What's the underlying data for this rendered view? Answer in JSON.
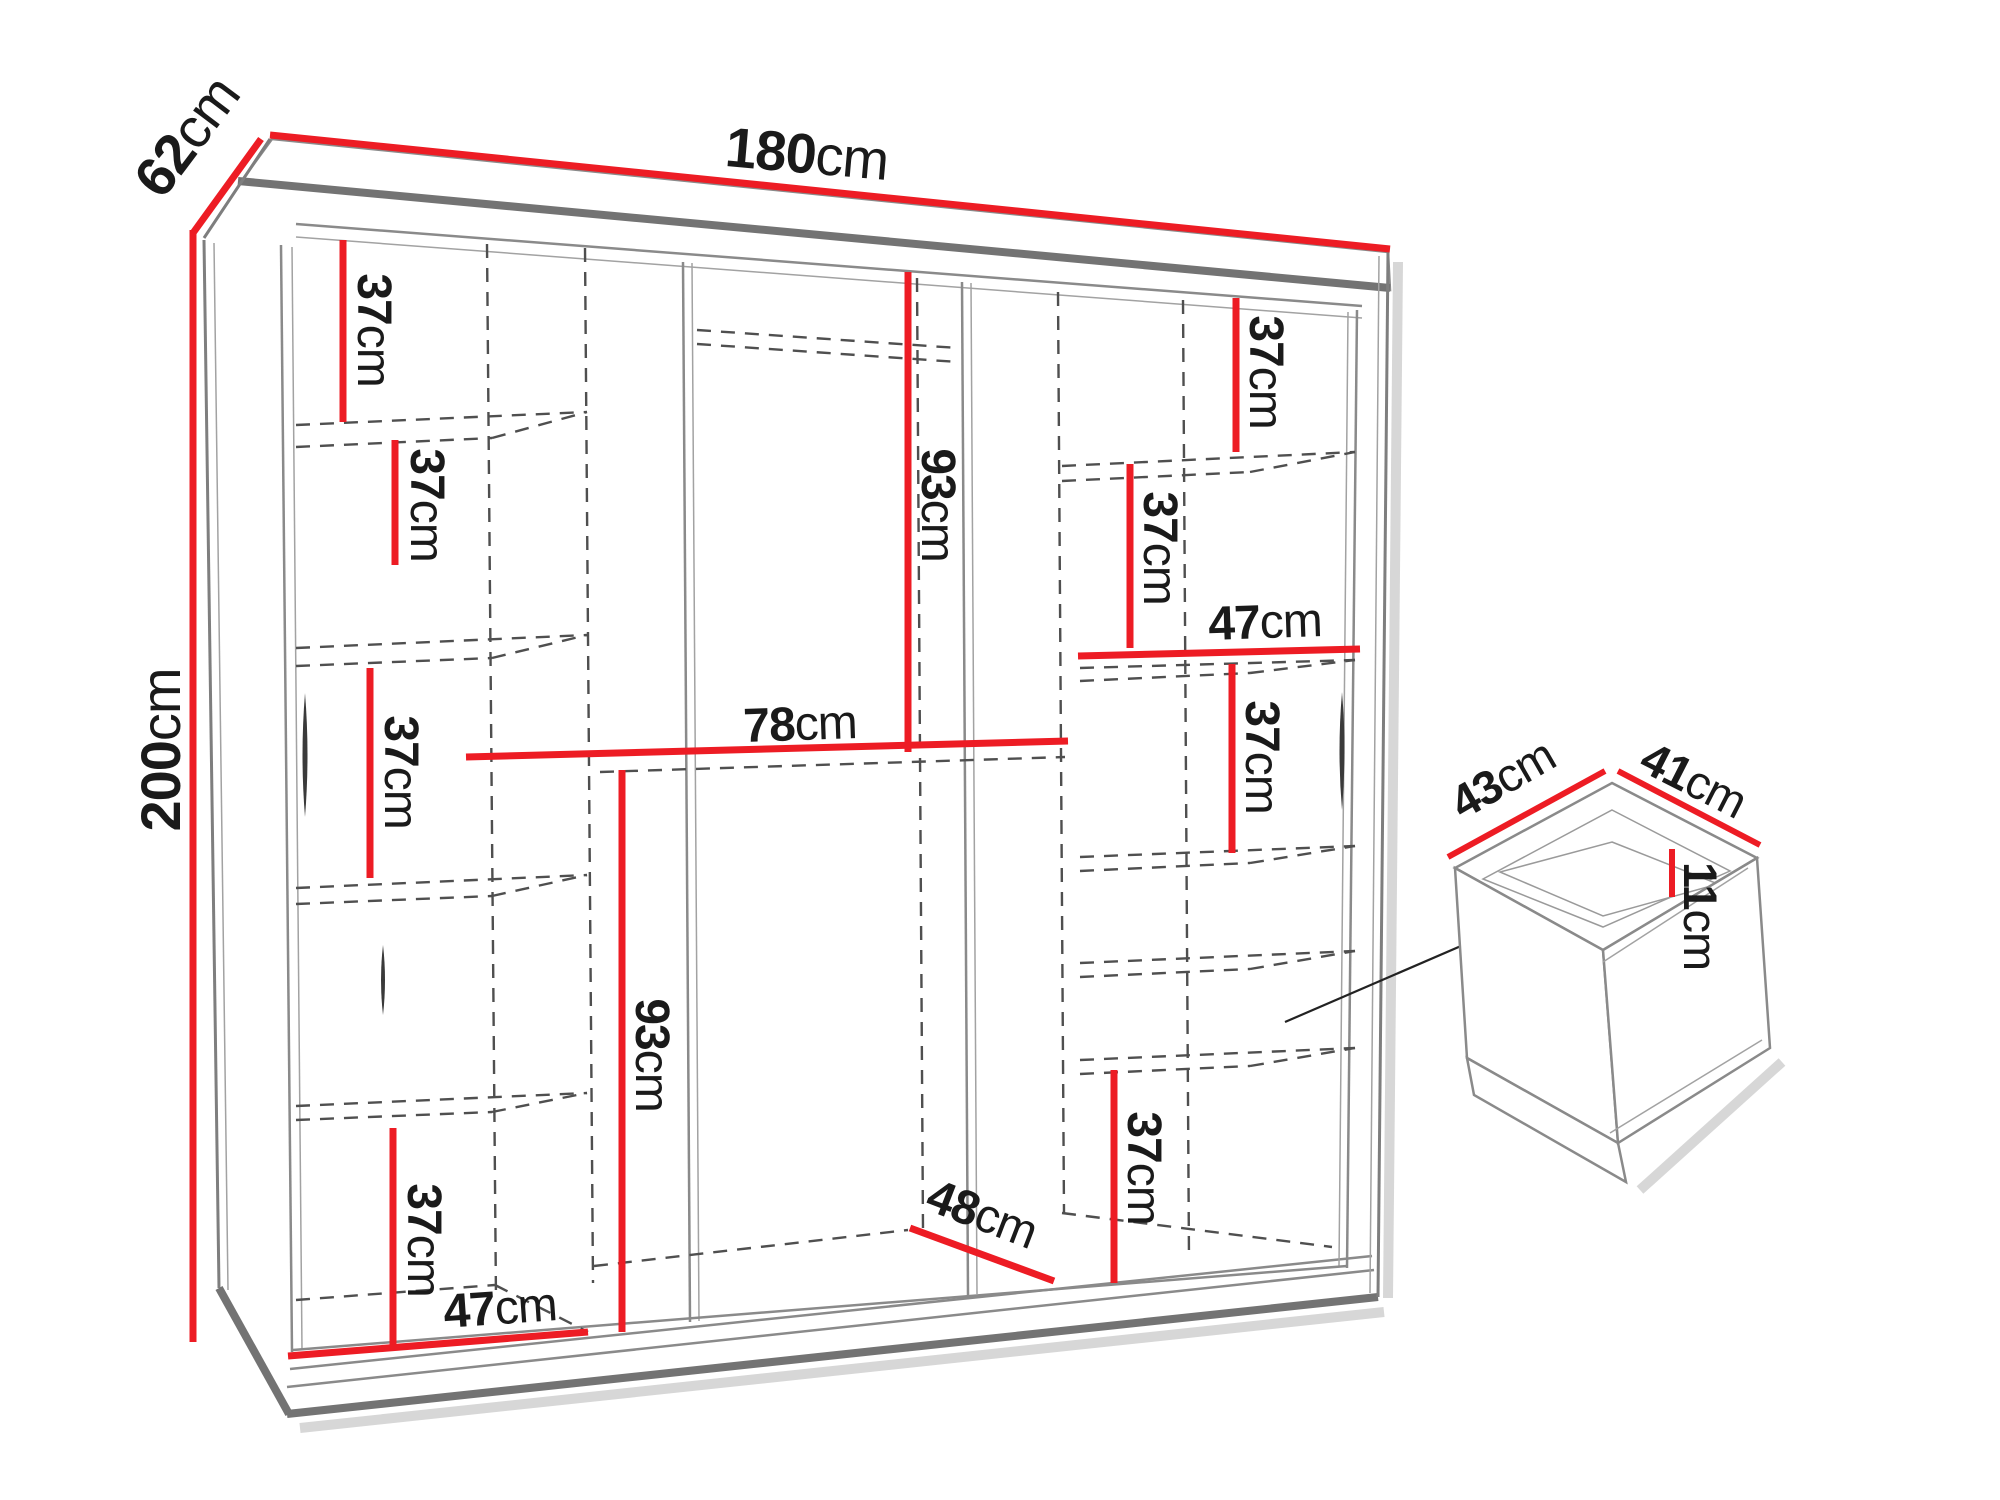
{
  "diagram": {
    "type": "furniture-dimension-diagram",
    "subject": "three-door sliding wardrobe with interior shelving and drawer detail",
    "units": "cm",
    "accent_color": "#ed1c24",
    "outline_color": "#7e7e7e",
    "dashed_color": "#4f4f4f",
    "text_color": "#1a1a1a",
    "background_color": "#ffffff"
  },
  "labels": {
    "width": {
      "num": "180",
      "unit": "cm"
    },
    "depth": {
      "num": "62",
      "unit": "cm"
    },
    "height": {
      "num": "200",
      "unit": "cm"
    },
    "left_shelf_1": {
      "num": "37",
      "unit": "cm"
    },
    "left_shelf_2": {
      "num": "37",
      "unit": "cm"
    },
    "left_shelf_3": {
      "num": "37",
      "unit": "cm"
    },
    "left_shelf_4": {
      "num": "37",
      "unit": "cm"
    },
    "left_bottom_width": {
      "num": "47",
      "unit": "cm"
    },
    "mid_upper_height": {
      "num": "93",
      "unit": "cm"
    },
    "mid_shelf_width": {
      "num": "78",
      "unit": "cm"
    },
    "mid_lower_height": {
      "num": "93",
      "unit": "cm"
    },
    "mid_floor_depth": {
      "num": "48",
      "unit": "cm"
    },
    "right_shelf_1": {
      "num": "37",
      "unit": "cm"
    },
    "right_shelf_2": {
      "num": "37",
      "unit": "cm"
    },
    "right_shelf_width": {
      "num": "47",
      "unit": "cm"
    },
    "right_shelf_3": {
      "num": "37",
      "unit": "cm"
    },
    "right_shelf_4": {
      "num": "37",
      "unit": "cm"
    },
    "drawer_width": {
      "num": "43",
      "unit": "cm"
    },
    "drawer_depth": {
      "num": "41",
      "unit": "cm"
    },
    "drawer_height": {
      "num": "11",
      "unit": "cm"
    }
  }
}
